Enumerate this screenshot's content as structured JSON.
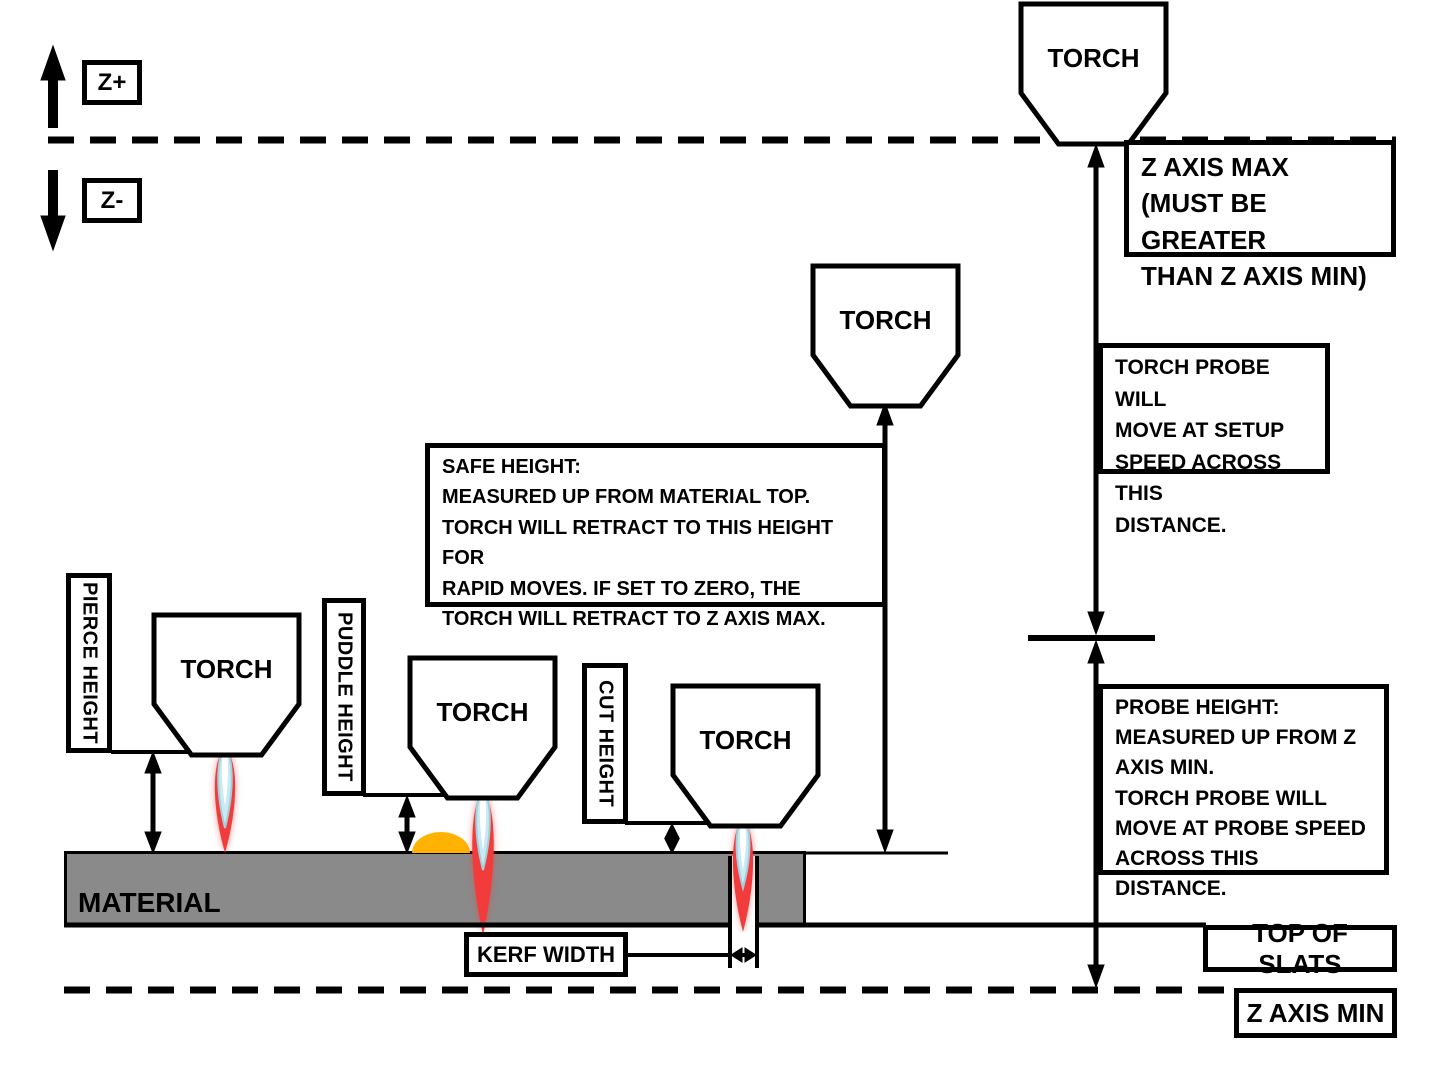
{
  "colors": {
    "line": "#000000",
    "material_fill": "#8a8a8a",
    "puddle": "#ffb300",
    "flame_red": "#f23c3c",
    "flame_blue": "#cbe9f2",
    "flame_core": "#ffffff"
  },
  "axis_indicator": {
    "up_label": "Z+",
    "down_label": "Z-"
  },
  "torch_label": "TORCH",
  "material_label": "MATERIAL",
  "height_labels": {
    "pierce": "PIERCE HEIGHT",
    "puddle": "PUDDLE HEIGHT",
    "cut": "CUT HEIGHT",
    "kerf": "KERF WIDTH"
  },
  "notes": {
    "z_axis_max": "Z AXIS MAX\n(MUST BE GREATER\nTHAN Z AXIS MIN)",
    "setup_speed": "TORCH PROBE WILL\nMOVE AT SETUP\nSPEED ACROSS THIS\nDISTANCE.",
    "safe_height": "SAFE HEIGHT:\nMEASURED UP FROM MATERIAL TOP.\nTORCH WILL RETRACT TO THIS HEIGHT FOR\nRAPID MOVES.  IF SET TO ZERO, THE\nTORCH WILL RETRACT TO Z AXIS MAX.",
    "probe_height": "PROBE HEIGHT:\nMEASURED UP FROM Z\nAXIS MIN.\nTORCH PROBE WILL\nMOVE AT PROBE SPEED\nACROSS THIS DISTANCE.",
    "top_of_slats": "TOP OF SLATS",
    "z_axis_min": "Z AXIS MIN"
  }
}
